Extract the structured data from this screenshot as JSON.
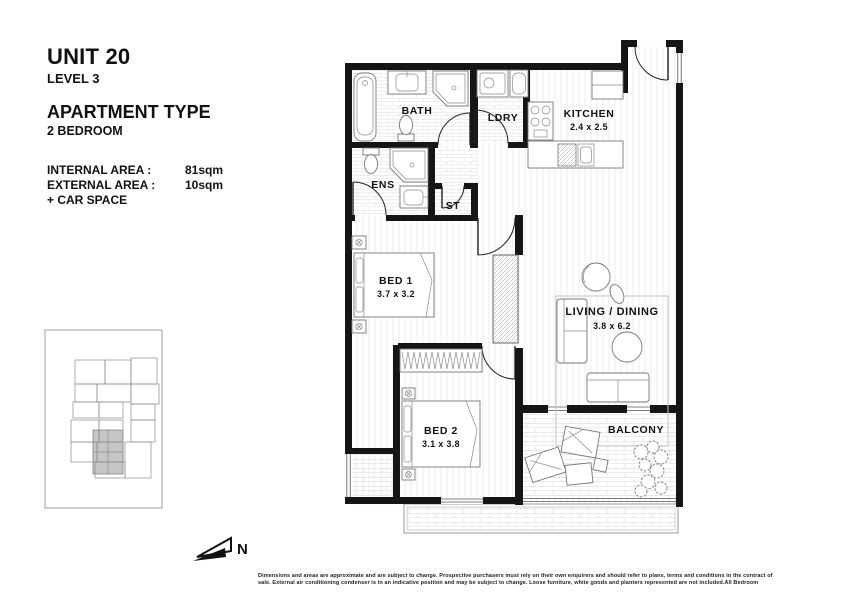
{
  "header": {
    "unit": "UNIT 20",
    "level": "LEVEL 3",
    "apartment_type": "APARTMENT TYPE",
    "bedrooms": "2 BEDROOM",
    "areas": {
      "internal_label": "INTERNAL AREA :",
      "internal_value": "81sqm",
      "external_label": "EXTERNAL AREA :",
      "external_value": "10sqm",
      "car_space": "+ CAR SPACE"
    }
  },
  "floorplan": {
    "rooms": [
      {
        "name": "BATH",
        "dims": ""
      },
      {
        "name": "LDRY",
        "dims": ""
      },
      {
        "name": "KITCHEN",
        "dims": "2.4 x 2.5"
      },
      {
        "name": "ENS",
        "dims": ""
      },
      {
        "name": "ST",
        "dims": ""
      },
      {
        "name": "BED 1",
        "dims": "3.7 x 3.2"
      },
      {
        "name": "LIVING / DINING",
        "dims": "3.8 x 6.2"
      },
      {
        "name": "BED 2",
        "dims": "3.1 x 3.8"
      },
      {
        "name": "BALCONY",
        "dims": ""
      }
    ]
  },
  "compass": {
    "label": "N"
  },
  "disclaimer": {
    "line1": "Dimensions and areas are approximate and are subject to change. Prospective purchasers must rely on their own enquirers and should refer to plans, terms and conditions in the contract of",
    "line2": "sale. External air conditioning condenser is in an indicative position and may be subject to change. Loose furniture, white goods and planters represented are not included.All Bedroom"
  },
  "colors": {
    "wall": "#151515",
    "fixture_stroke": "#777777",
    "keyplan_highlight": "#c6c6c6"
  }
}
